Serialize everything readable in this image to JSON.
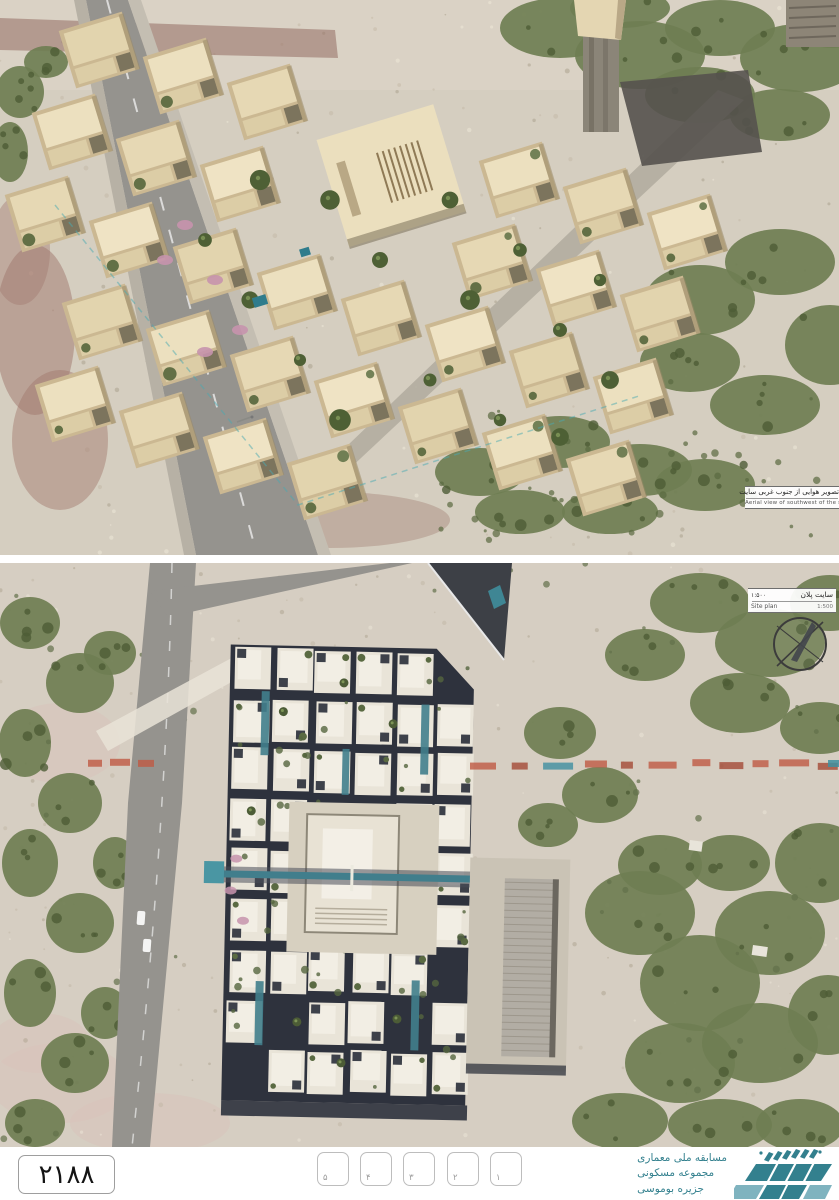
{
  "sheet": {
    "number_fa": "۲۱۸۸",
    "pages": [
      "۵",
      "۴",
      "۳",
      "۲",
      "۱"
    ]
  },
  "aerial_view": {
    "caption_fa": "تصویر هوایی از جنوب غربی سایت",
    "caption_en": "Aerial view of southwest of the site"
  },
  "site_plan": {
    "title_fa": "سایت پلان",
    "scale_fa": "۱:۵۰۰",
    "title_en": "Site plan",
    "scale_en": "1:500"
  },
  "logo": {
    "line1_fa": "مسابقه ملی معماری",
    "line2_fa": "مجموعه مسکونی",
    "line3_fa": "جزیره بوموسی"
  },
  "colors": {
    "logo_teal": "#33808e",
    "logo_teal_light": "#7fb3bf",
    "boundary_orange": "#bf5a43",
    "pool_teal": "#417e8c",
    "sand_top": "#d5cec0",
    "sand_plan": "#d6cec2",
    "vegetation": "#6f7e52",
    "vegetation_dark": "#4d5c36",
    "road_gray": "#95938e",
    "building_beige": "#e9ddbd",
    "building_wall": "#cbb892",
    "plan_roof_white": "#e9e4d8",
    "plan_shadow_navy": "#2e323d",
    "tower_gray": "#8b8578",
    "asphalt_dark": "#55524e"
  }
}
